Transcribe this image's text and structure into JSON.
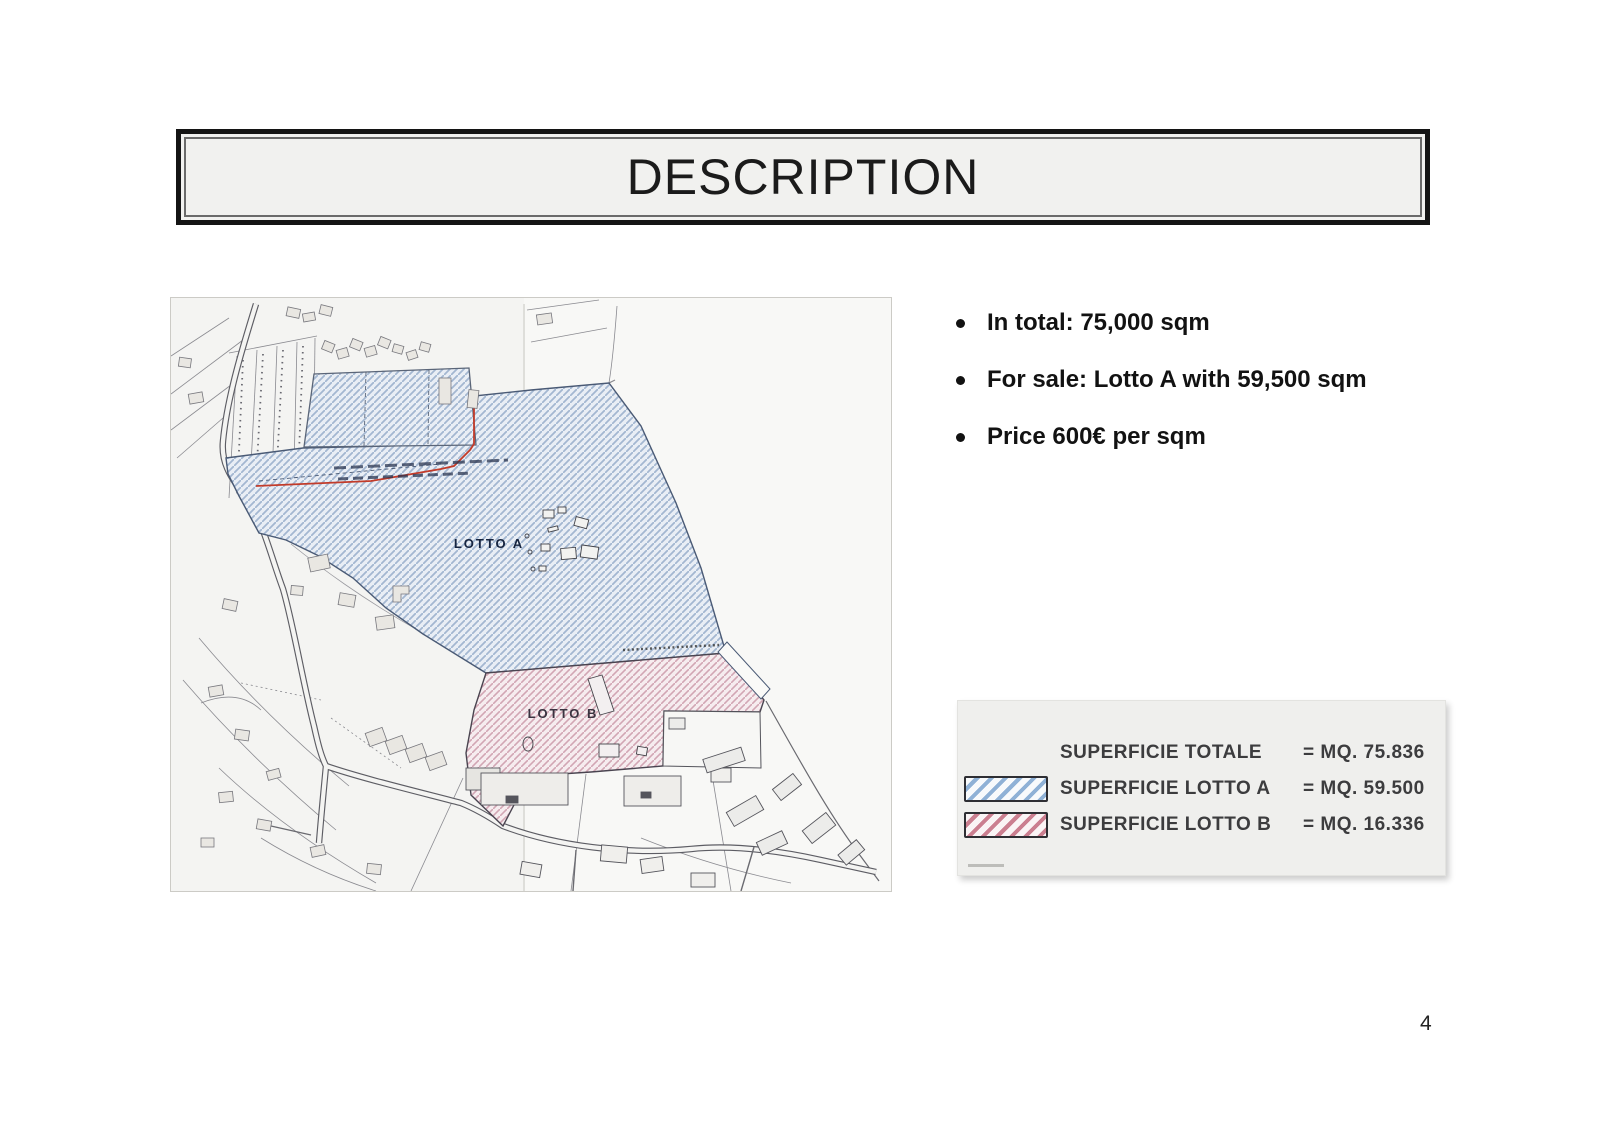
{
  "title": {
    "text": "DESCRIPTION"
  },
  "bullets": [
    {
      "text": "In total: 75,000 sqm"
    },
    {
      "text": "For sale: Lotto A with 59,500 sqm"
    },
    {
      "text": "Price 600€ per sqm"
    }
  ],
  "map": {
    "labels": {
      "lotto_a": "LOTTO A",
      "lotto_b": "LOTTO B"
    },
    "colors": {
      "lotto_a_fill": "#e9eef5",
      "lotto_a_hatch": "#a3b7d1",
      "lotto_a_outline": "#4a5a75",
      "lotto_b_fill": "#f6ecef",
      "lotto_b_hatch": "#d2a6b4",
      "lotto_b_outline": "#4a4450",
      "boundary_red": "#c23b2a",
      "parcel_line": "#7c7c84"
    }
  },
  "legend": {
    "rows": [
      {
        "swatch": "none",
        "label": "SUPERFICIE TOTALE",
        "value": "= MQ. 75.836"
      },
      {
        "swatch": "blue",
        "label": "SUPERFICIE LOTTO A",
        "value": "= MQ. 59.500"
      },
      {
        "swatch": "pink",
        "label": "SUPERFICIE LOTTO B",
        "value": "= MQ. 16.336"
      }
    ]
  },
  "page": {
    "number": "4"
  }
}
